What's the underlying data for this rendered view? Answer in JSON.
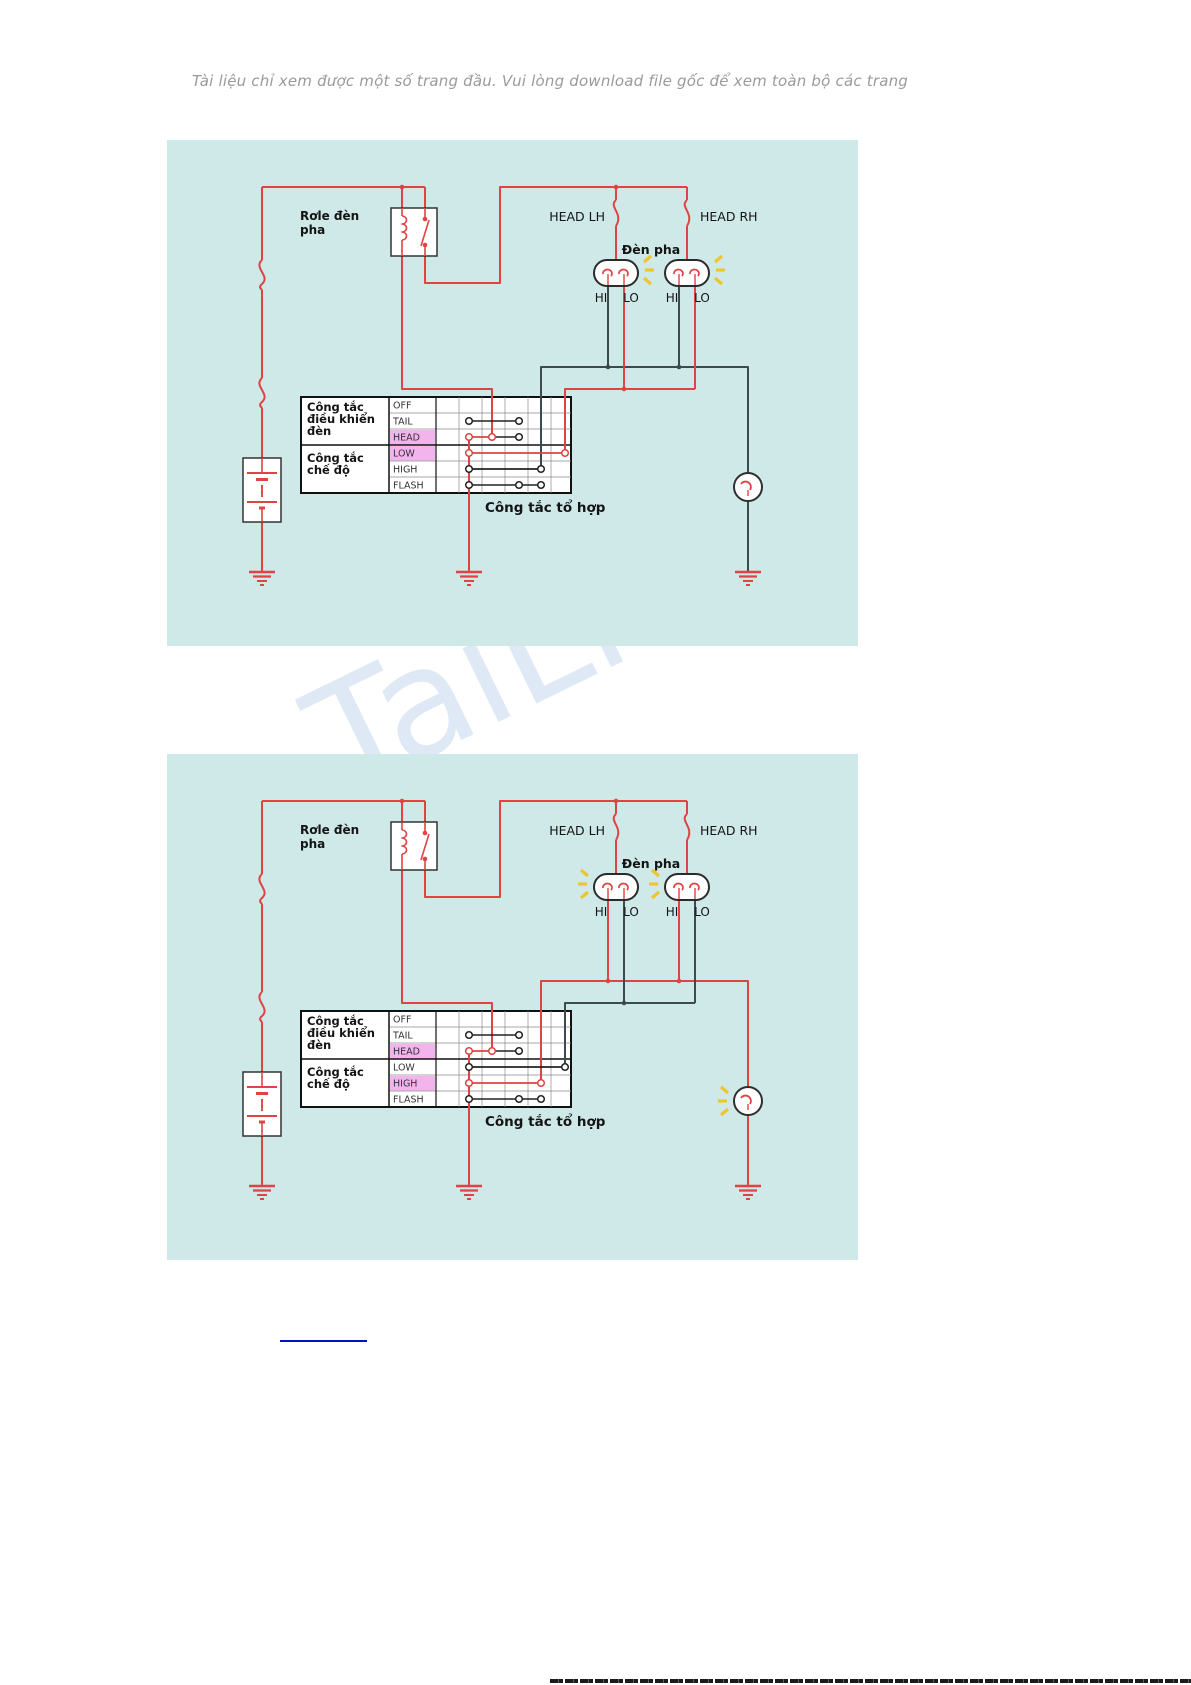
{
  "page": {
    "notice": "Tài liệu chỉ xem được một số trang đầu. Vui lòng download file gốc để xem toàn bộ các trang",
    "watermark": "TaiLieu"
  },
  "colors": {
    "panel_bg": "#cfe9e9",
    "wire_live": "#df4343",
    "wire_dead": "#3e4b4e",
    "contact_dark": "#222222",
    "highlight": "#f3b4ee",
    "spark": "#eec52f",
    "link_blue": "#0011cc",
    "label_text": "#141414"
  },
  "diagram_labels": {
    "relay": [
      "Rơle đèn",
      "pha"
    ],
    "fuse_left": "HEAD LH",
    "fuse_right": "HEAD RH",
    "headlamp": "Đèn pha",
    "hi": "HI",
    "lo": "LO",
    "switch1": [
      "Công tắc",
      "điều khiển",
      "đèn"
    ],
    "switch2": [
      "Công tắc",
      "chế độ"
    ],
    "rows": [
      "OFF",
      "TAIL",
      "HEAD",
      "LOW",
      "HIGH",
      "FLASH"
    ],
    "caption": "Công tắc tổ hợp"
  },
  "diagrams": [
    {
      "name": "low-beam",
      "active_rows": [
        "HEAD",
        "LOW"
      ],
      "lit": "LO",
      "indicator_lit": false
    },
    {
      "name": "high-beam",
      "active_rows": [
        "HEAD",
        "HIGH"
      ],
      "lit": "HI",
      "indicator_lit": true
    }
  ]
}
